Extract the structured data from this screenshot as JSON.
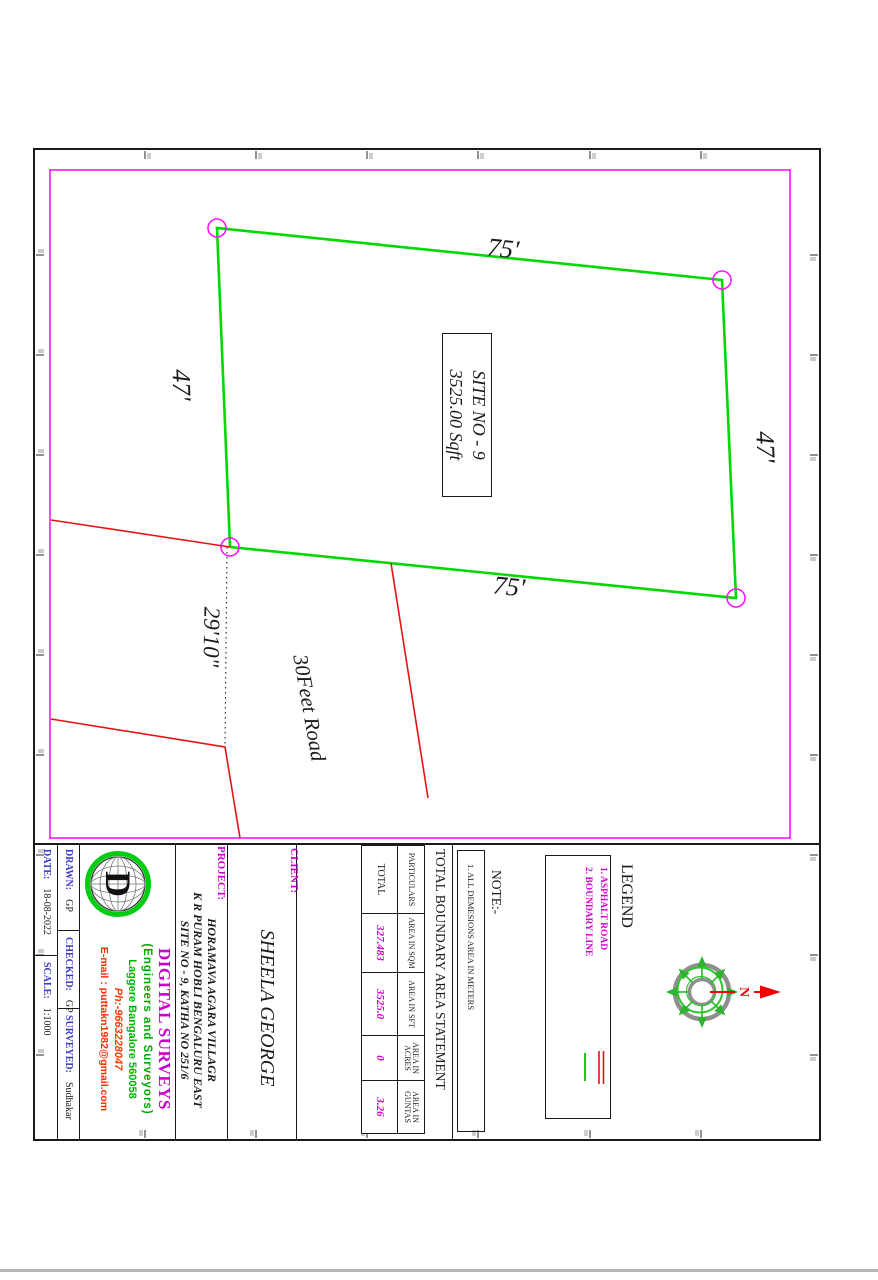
{
  "drawing": {
    "site_box": {
      "line1": "SITE NO - 9",
      "line2": "3525.00 Sqft"
    },
    "dimensions": {
      "left": "75'",
      "right": "75'",
      "top": "47'",
      "bottom": "47'",
      "road_width": "29'10\""
    },
    "road_label": "30Feet Road",
    "compass": {
      "north": "N"
    }
  },
  "legend": {
    "title": "LEGEND",
    "items": [
      "1. ASPHALT ROAD",
      "2. BOUNDARY LINE"
    ]
  },
  "note": {
    "title": "NOTE:-",
    "items": [
      "1. ALL DEMESIONS AREA IN METERS"
    ]
  },
  "area_table": {
    "title": "TOTAL BOUNDARY AREA STATEMENT",
    "headers": [
      "PARTICULARS",
      "AREA IN SQM",
      "AREA IN SFT",
      "AREA IN ACRES",
      "AREA IN GUNTAS"
    ],
    "rows": [
      [
        "TOTAL",
        "327.483",
        "3525.0",
        "0",
        "3.26"
      ]
    ]
  },
  "client": {
    "label": "CLIENT:",
    "name": "SHEELA GEORGE"
  },
  "project": {
    "label": "PROJECT:",
    "lines": [
      "HORAMAVA AGARA VILLAGR",
      "K R PURAM HOBLI BENGALURU EAST",
      "SITE NO - 9, KATHA NO 251/6"
    ]
  },
  "company": {
    "logo_letter": "D",
    "name": "DIGITAL SURVEYS",
    "tagline": "(Engineers and Surveyors)",
    "address": "Laggere Bangalore 560058",
    "phone": "Ph:-9663228047",
    "email": "E-mail : puttakn1982@gmail.com"
  },
  "meta": {
    "drawn_label": "DRAWN:",
    "drawn": "GP",
    "checked_label": "CHECKED:",
    "checked": "GP",
    "surveyed_label": "SURVEYED:",
    "surveyed": "Sudhakar",
    "date_label": "DATE:",
    "date": "18-08-2022",
    "scale_label": "SCALE:",
    "scale": "1:1000"
  },
  "colors": {
    "boundary_green": "#00d900",
    "border_magenta": "#ff14ff",
    "road_red": "#e51414",
    "label_blue": "#3a3ac8",
    "value_magenta": "#cc00cc"
  }
}
